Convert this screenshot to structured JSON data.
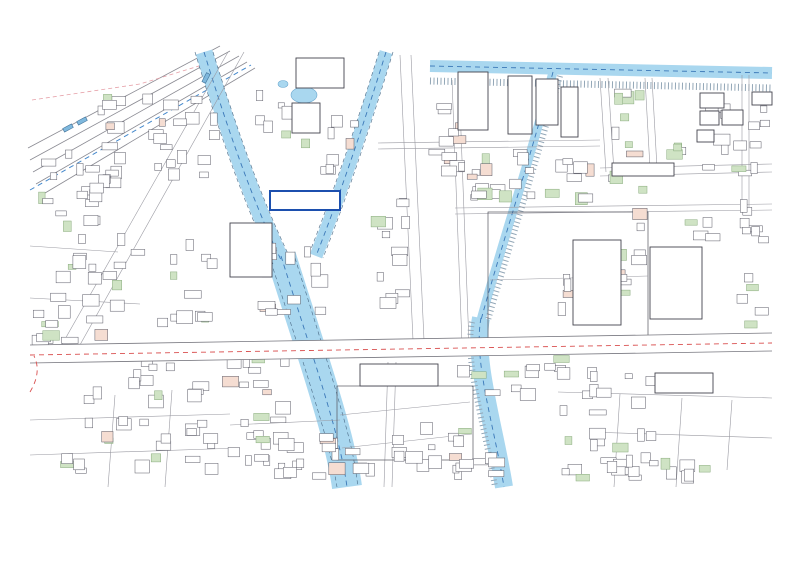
{
  "page": {
    "background": "#ffffff"
  },
  "map": {
    "colors": {
      "river_fill": "#a9d7ef",
      "river_dash": "#3b78b8",
      "bank_dash": "#4a6a86",
      "line": "#55555f",
      "street": "#9a9aa2",
      "red_dash": "#d94f4f",
      "red_line": "#c84848",
      "red_label": "#e06a6a",
      "faint_red_label": "#eba39d",
      "blue_label": "#1c4fae",
      "green_fill": "#cfe3c4",
      "green_stroke": "#88aa7c",
      "pink_fill": "#f5ddd2",
      "parcel_fill": "#f2c5bf",
      "parcel_stroke": "#c8897f",
      "marker_fill": "#1d3f78",
      "hatch": "#93a7b7",
      "rail": "#8a8a92",
      "pink_dash": "#e6a0a8",
      "car_fill": "#7fb8dd",
      "building_stroke": "#5a5a66"
    },
    "target_label": {
      "text": "対象地"
    },
    "labels": [
      {
        "name": "company-matsusaka",
        "text": "㈱マツサカ",
        "x": 103,
        "y": 196,
        "size": 5.5,
        "color": "#333333"
      },
      {
        "name": "motor-pool",
        "text": "モータープール",
        "x": 396,
        "y": 171,
        "size": 5,
        "color": "#333333"
      },
      {
        "name": "garage",
        "text": "個人ガレージ",
        "x": 437,
        "y": 193,
        "size": 4.6,
        "color": "#333333"
      },
      {
        "name": "asahi-depot",
        "text": "朝日配車場",
        "x": 484,
        "y": 210,
        "size": 4.6,
        "color": "#333333"
      },
      {
        "name": "company-block",
        "text": "㈱プローブ\n㈱シンセル配送センター\n㈱オスト配送センター\n大鋼商事㈱相生倉庫1F",
        "x": 397,
        "y": 220,
        "size": 4.4,
        "color": "#333333"
      },
      {
        "name": "gran-court",
        "text": "グラン・コート塚屋川",
        "x": 386,
        "y": 376,
        "size": 5.2,
        "color": "#333333"
      },
      {
        "name": "kansera",
        "text": "㈱カンセラ",
        "x": 446,
        "y": 371,
        "size": 5.2,
        "color": "#333333"
      },
      {
        "name": "coco-plaza",
        "text": "ココプラザ",
        "x": 676,
        "y": 383,
        "size": 6,
        "color": "#333333"
      },
      {
        "name": "parking-lot",
        "text": "駐車場",
        "x": 649,
        "y": 169,
        "size": 4.8,
        "color": "#333333"
      },
      {
        "name": "district-ainae2-east",
        "text": "相濃２丁目",
        "x": 671,
        "y": 354,
        "size": 9,
        "color": "#e06a6a"
      },
      {
        "name": "district-ainae2-south",
        "text": "相濃２丁目",
        "x": 581,
        "y": 417,
        "size": 8.5,
        "color": "#e06a6a"
      },
      {
        "name": "district-ainae1",
        "text": "相濃１丁目",
        "x": 483,
        "y": 234,
        "size": 8,
        "color": "#eba39d"
      },
      {
        "name": "district-motohama3",
        "text": "元浜３丁目",
        "x": 240,
        "y": 278,
        "size": 7,
        "color": "#eba39d"
      },
      {
        "name": "kosei-en",
        "text": "幸生園",
        "x": 150,
        "y": 414,
        "size": 6.5,
        "color": "#d95555",
        "boxed": "#d95555"
      },
      {
        "name": "tsukayagawa-red",
        "text": "塚屋川門",
        "x": 332,
        "y": 250,
        "size": 7.5,
        "color": "#eba39d"
      },
      {
        "name": "river-name",
        "text": "塚屋川",
        "x": 242,
        "y": 237,
        "size": 5.5,
        "color": "#2266aa",
        "vertical": true
      },
      {
        "name": "block-c",
        "text": "C",
        "x": 706,
        "y": 95,
        "size": 7,
        "color": "#333333"
      },
      {
        "name": "block-d",
        "text": "D",
        "x": 703,
        "y": 113,
        "size": 7,
        "color": "#333333"
      },
      {
        "name": "block-e",
        "text": "E",
        "x": 700,
        "y": 132,
        "size": 7,
        "color": "#333333"
      },
      {
        "name": "block-b",
        "text": "B",
        "x": 726,
        "y": 112,
        "size": 7,
        "color": "#333333"
      },
      {
        "name": "block-a",
        "text": "A",
        "x": 756,
        "y": 94,
        "size": 7,
        "color": "#333333"
      },
      {
        "name": "route-label",
        "text": "国道23(沿)",
        "x": 403,
        "y": 336,
        "size": 4.2,
        "color": "#444444"
      },
      {
        "name": "pref-road",
        "text": "(主)名古屋刈谷線",
        "x": 127,
        "y": 212,
        "size": 4.2,
        "color": "#444444",
        "vertical": true
      },
      {
        "name": "teisen",
        "text": "テイセン工業",
        "x": 407,
        "y": 107,
        "size": 4.6,
        "color": "#333333"
      },
      {
        "name": "bldg-fortere",
        "text": "フォルテール",
        "x": 533,
        "y": 89,
        "size": 4.4,
        "color": "#333333",
        "vertical": true
      },
      {
        "name": "bldg-meishin",
        "text": "メイシンタワー",
        "x": 559,
        "y": 89,
        "size": 4.4,
        "color": "#333333",
        "vertical": true
      },
      {
        "name": "onsen",
        "text": "黒木温泉",
        "x": 188,
        "y": 445,
        "size": 4.4,
        "color": "#333333"
      },
      {
        "name": "haitsu",
        "text": "大沼ハイツ",
        "x": 185,
        "y": 385,
        "size": 4.4,
        "color": "#333333",
        "vertical": true
      },
      {
        "name": "seiko",
        "text": "中部製鋼㈱",
        "x": 299,
        "y": 66,
        "size": 4.4,
        "color": "#333333"
      },
      {
        "name": "unyu",
        "text": "㈱相生運輸",
        "x": 97,
        "y": 367,
        "size": 4.4,
        "color": "#333333"
      }
    ],
    "circled_numbers": [
      {
        "x": 85,
        "y": 126,
        "n": "2"
      },
      {
        "x": 160,
        "y": 186,
        "n": "1"
      },
      {
        "x": 302,
        "y": 70,
        "n": "4"
      },
      {
        "x": 437,
        "y": 98,
        "n": "1"
      },
      {
        "x": 718,
        "y": 97,
        "n": "3"
      },
      {
        "x": 605,
        "y": 120,
        "n": "6"
      },
      {
        "x": 622,
        "y": 160,
        "n": "4"
      },
      {
        "x": 686,
        "y": 188,
        "n": "2"
      },
      {
        "x": 518,
        "y": 255,
        "n": "1"
      },
      {
        "x": 588,
        "y": 262,
        "n": "5"
      },
      {
        "x": 686,
        "y": 271,
        "n": "7"
      },
      {
        "x": 352,
        "y": 394,
        "n": "3"
      },
      {
        "x": 312,
        "y": 370,
        "n": "2"
      },
      {
        "x": 244,
        "y": 431,
        "n": "4"
      },
      {
        "x": 120,
        "y": 324,
        "n": "1"
      },
      {
        "x": 560,
        "y": 409,
        "n": "3"
      },
      {
        "x": 596,
        "y": 367,
        "n": "5"
      },
      {
        "x": 620,
        "y": 446,
        "n": "6"
      },
      {
        "x": 100,
        "y": 241,
        "n": "1"
      },
      {
        "x": 478,
        "y": 237,
        "n": "2"
      }
    ],
    "markers": [
      {
        "name": "map-pin-west",
        "x": 133,
        "y": 350
      },
      {
        "name": "map-pin-east",
        "x": 588,
        "y": 329
      }
    ]
  }
}
